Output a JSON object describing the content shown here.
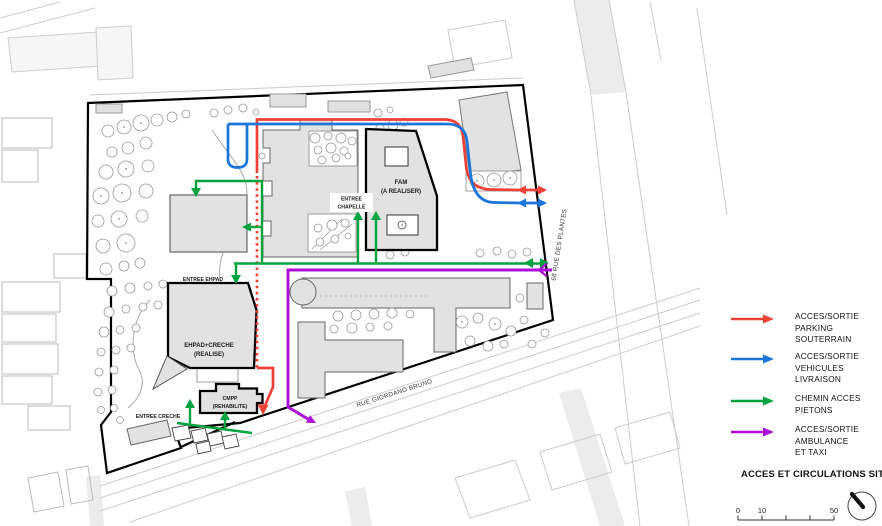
{
  "legend": {
    "title": "ACCES ET CIRCULATIONS SITE",
    "items": [
      {
        "name": "parking",
        "color": "#ee4137",
        "lines": [
          "ACCES/SORTIE",
          "PARKING",
          "SOUTERRAIN"
        ]
      },
      {
        "name": "livraison",
        "color": "#1c75d8",
        "lines": [
          "ACCES/SORTIE",
          "VEHICULES",
          "LIVRAISON"
        ]
      },
      {
        "name": "pietons",
        "color": "#00a33e",
        "lines": [
          "CHEMIN ACCES",
          "PIETONS"
        ]
      },
      {
        "name": "ambulance",
        "color": "#ab0fd8",
        "lines": [
          "ACCES/SORTIE",
          "AMBULANCE",
          "ET TAXI"
        ]
      }
    ]
  },
  "scale": {
    "labels": [
      "0",
      "10",
      "50"
    ]
  },
  "plan": {
    "streets": {
      "giordano": "RUE GIORDANO BRUNO",
      "plantes": "68 RUE DES PLANTES"
    },
    "labels": {
      "fam": [
        "FAM",
        "(A REALISER)"
      ],
      "ehpad": [
        "EHPAD+CRECHE",
        "(REALISE)"
      ],
      "cmpp": [
        "CMPP",
        "(REHABILITE)"
      ],
      "chapelle": [
        "ENTREE",
        "CHAPELLE"
      ],
      "entree_ehpad": "ENTREE EHPAD",
      "entree_creche": "ENTREE CRECHE"
    }
  }
}
